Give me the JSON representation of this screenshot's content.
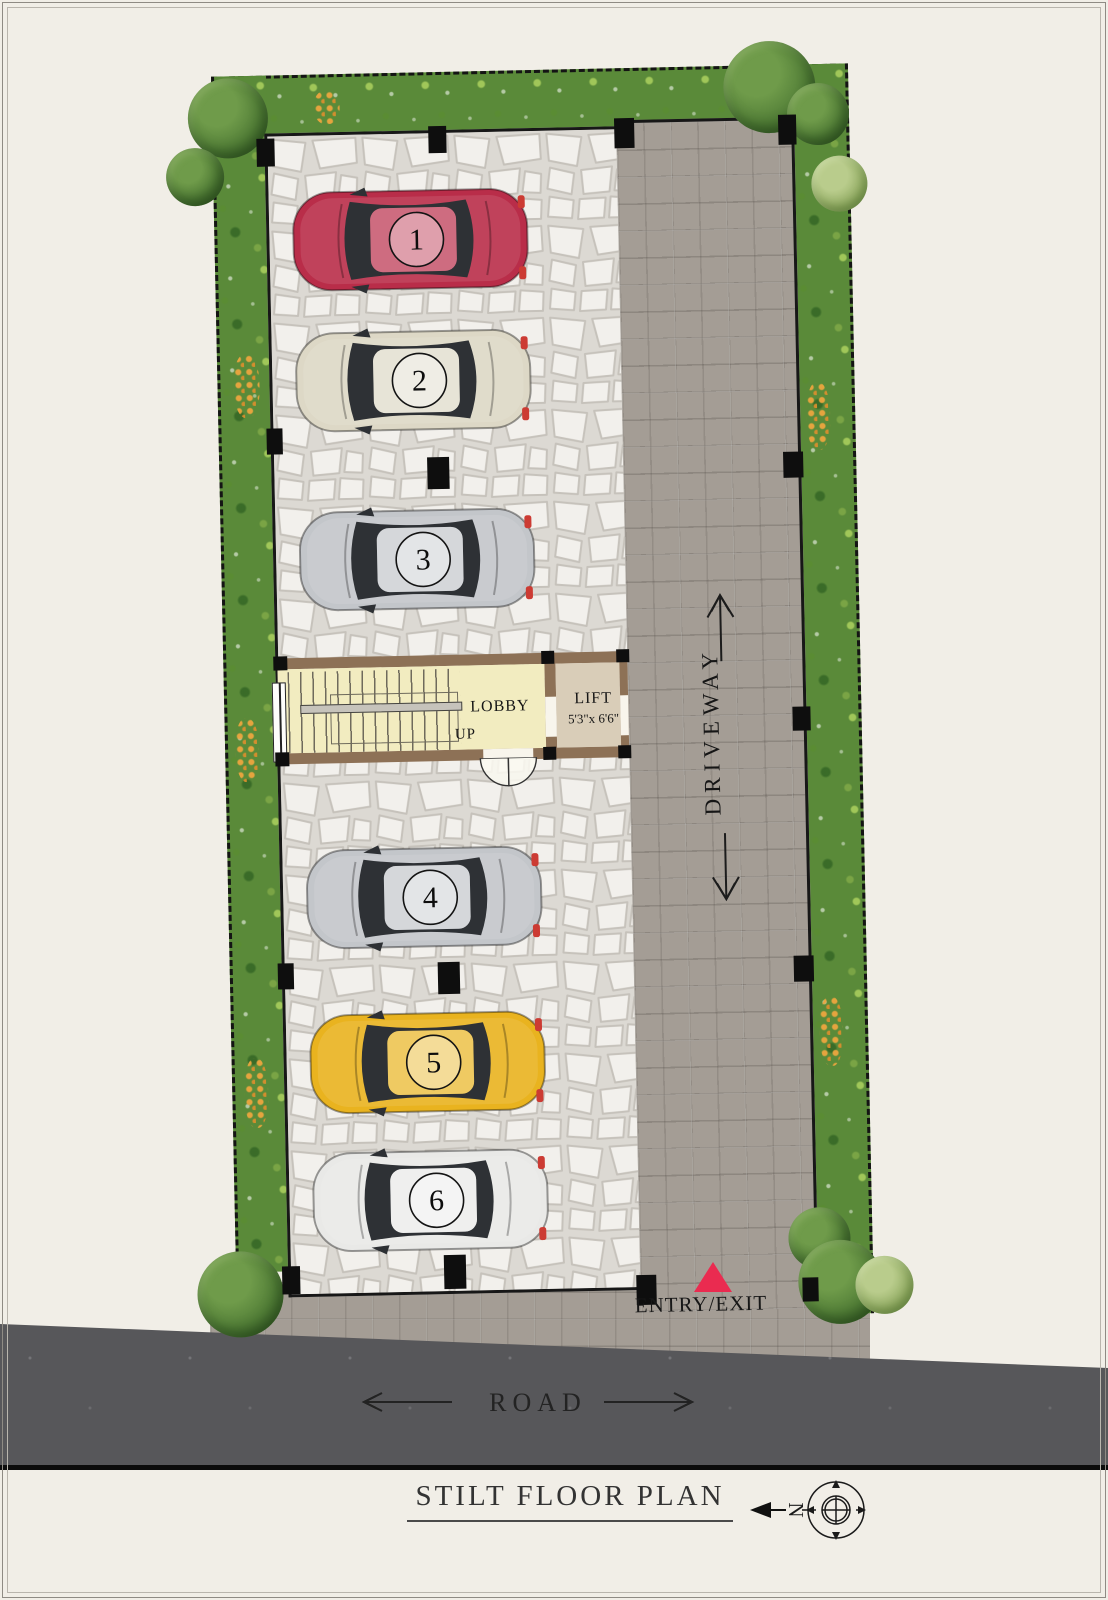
{
  "title": "STILT FLOOR PLAN",
  "north_label": "N",
  "road_label": "ROAD",
  "entry_label": "ENTRY/EXIT",
  "driveway_label": "DRIVEWAY",
  "lobby_label": "LOBBY",
  "up_label": "UP",
  "lift_label": "LIFT",
  "lift_size": "5'3\"x 6'6\"",
  "cars": [
    {
      "number": "1",
      "color": "#b92d49"
    },
    {
      "number": "2",
      "color": "#ddd8c6"
    },
    {
      "number": "3",
      "color": "#c3c6ca"
    },
    {
      "number": "4",
      "color": "#c3c6ca"
    },
    {
      "number": "5",
      "color": "#e9b31f"
    },
    {
      "number": "6",
      "color": "#e9e9e7"
    }
  ],
  "colors": {
    "entry_triangle": "#ea2b50",
    "road": "#57575a",
    "greenery": "#5a8a39",
    "paver": "#a49d95",
    "wall": "#8d7156",
    "lobby_floor": "#f2ecc0",
    "lift_floor": "#d9cdb8"
  }
}
